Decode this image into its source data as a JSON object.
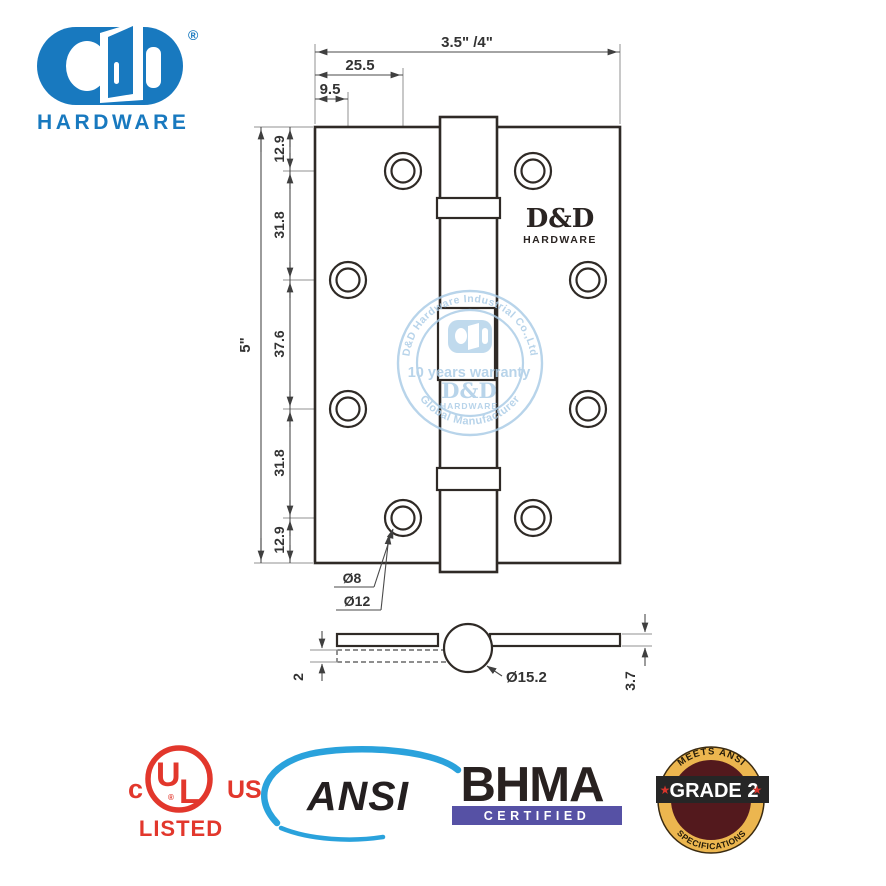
{
  "header": {
    "brand_sub": "HARDWARE",
    "registered": "®"
  },
  "drawing": {
    "dim_width": "3.5\" /4\"",
    "dim_offset_hole1": "25.5",
    "dim_offset_hole2": "9.5",
    "dim_height": "5\"",
    "segments": [
      "12.9",
      "31.8",
      "37.6",
      "31.8",
      "12.9"
    ],
    "hole_inner_dia": "Ø8",
    "hole_outer_dia": "Ø12",
    "leaf_thickness": "2",
    "knuckle_dia": "Ø15.2",
    "leaf_gap": "3.7",
    "plate_brand": "D&D",
    "plate_brand_sub": "HARDWARE"
  },
  "watermark": {
    "arc_top": "D&D Hardware Industrial Co.,Ltd",
    "line_1": "10 years warranty",
    "brand": "D&D",
    "brand_sub": "HARDWARE",
    "arc_bottom": "Global Manufacturer"
  },
  "certifications": {
    "ul": {
      "c": "c",
      "us": "US",
      "u": "U",
      "l": "L",
      "listed": "LISTED",
      "registered": "®",
      "color": "#e2372c"
    },
    "ansi": {
      "label": "ANSI",
      "swoosh_color": "#2aa2dc",
      "text_color": "#241f20"
    },
    "bhma": {
      "label": "BHMA",
      "certified": "CERTIFIED",
      "bar_color": "#5651a5",
      "text_color": "#282120"
    },
    "grade": {
      "arc_top": "MEETS ANSI",
      "band": "GRADE 2",
      "arc_bottom": "SPECIFICATIONS",
      "star": "★",
      "gold": "#ecb64f",
      "maroon": "#53191d",
      "band_color": "#262626",
      "star_color": "#d8342b"
    }
  },
  "colors": {
    "brand_blue": "#1879bf",
    "watermark_blue": "#a9cbe6"
  }
}
